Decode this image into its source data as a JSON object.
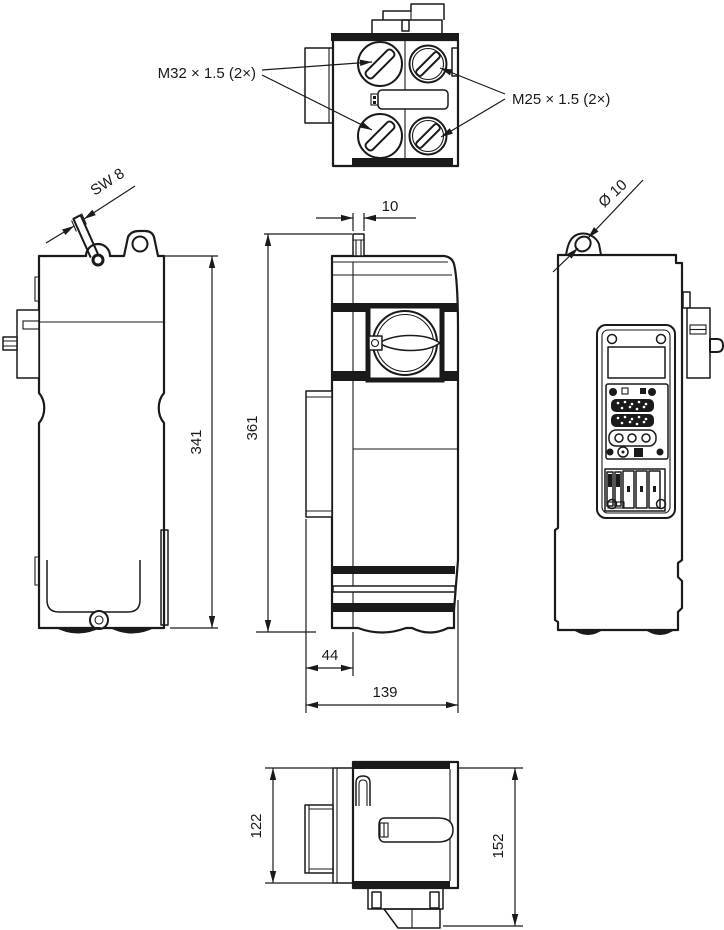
{
  "drawing": {
    "labels": {
      "gland_left": "M32 × 1.5 (2×)",
      "gland_right": "M25 × 1.5 (2×)",
      "wrench": "SW 8",
      "hole": "Ø 10"
    },
    "dimensions": {
      "body_height": "341",
      "total_height": "361",
      "stud_width": "10",
      "front_depth": "44",
      "total_width": "139",
      "body_depth": "122",
      "total_depth": "152"
    },
    "colors": {
      "line": "#1a1a1a",
      "background": "#ffffff"
    }
  }
}
